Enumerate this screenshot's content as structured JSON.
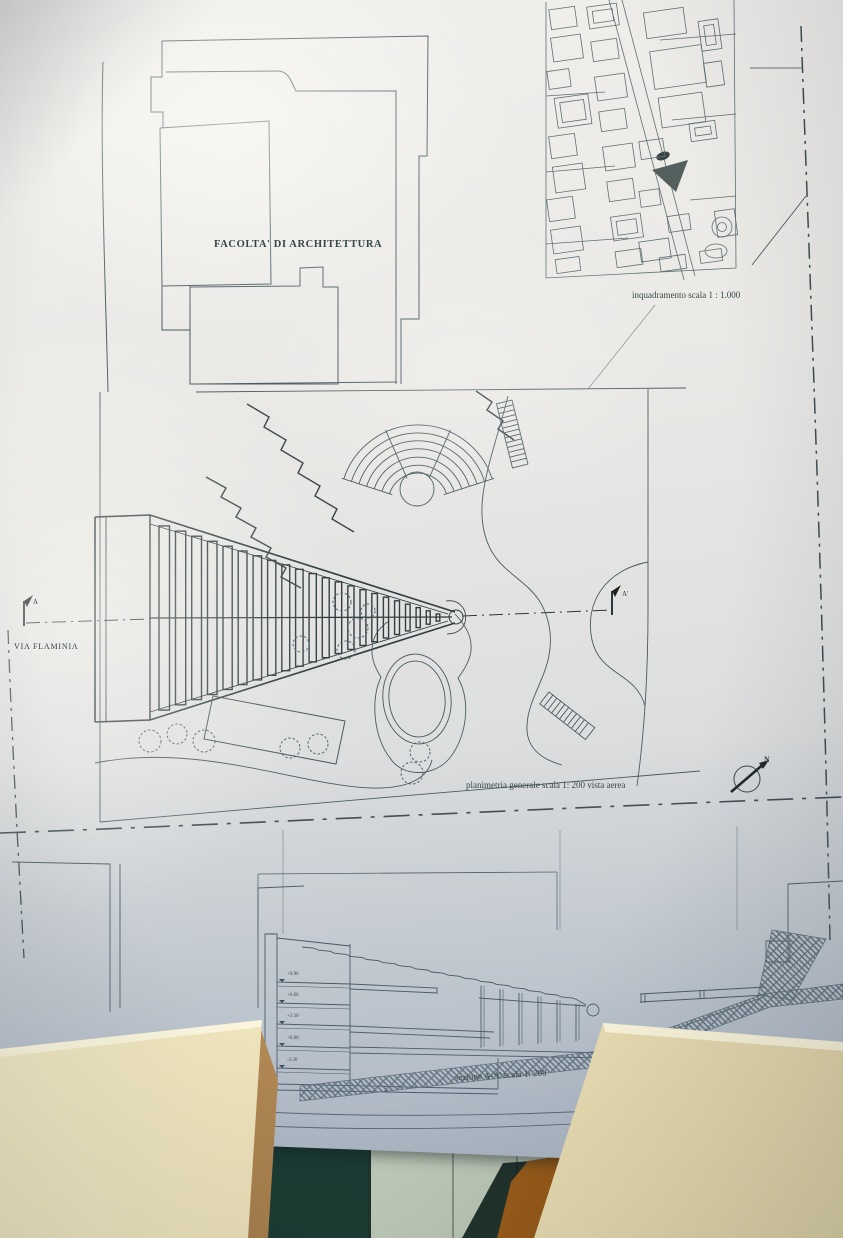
{
  "poster": {
    "campus_label": "FACOLTA' DI ARCHITETTURA",
    "map_caption": "inquadramento scala 1 : 1.000",
    "plan_caption": "planimetria generale scala 1: 200 vista aerea",
    "section_caption": "sezione A-A' scala 1: 200",
    "street_label": "VIA FLAMINIA",
    "section_marker_left": "A",
    "section_marker_right": "A'",
    "north_label": "N",
    "section_levels": [
      "+9.90",
      "+6.60",
      "+3.30",
      "+0.00",
      "-3.30"
    ]
  },
  "colors": {
    "paper": "#e9e8e4",
    "paper_shadow_blue": "#bcc4cc",
    "ink": "#44545a",
    "ink_dark": "#2c383c",
    "desk_cream": "#efe6c0",
    "desk_edge_highlight": "#faf4da",
    "wood_trim": "#c7a26d",
    "floor_teal": "#2c5f55",
    "cabinet_green": "#c6cfc0",
    "chair_orange": "#a9661c"
  }
}
